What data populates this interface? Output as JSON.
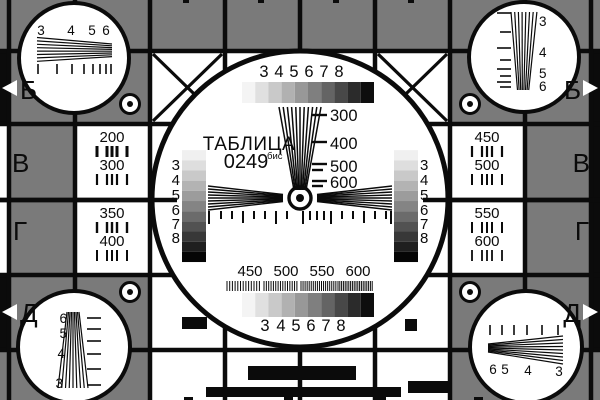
{
  "card": {
    "title_line1": "ТАБЛИЦА",
    "title_number": "0249",
    "title_superscript": "бис"
  },
  "row_labels": [
    "Б",
    "В",
    "Г",
    "Д"
  ],
  "scale_numbers": [
    "3",
    "4",
    "5",
    "6",
    "7",
    "8"
  ],
  "center_wedge_labels": [
    "300",
    "400",
    "500",
    "600"
  ],
  "bottom_freq_labels": [
    "450",
    "500",
    "550",
    "600"
  ],
  "freq_cells": {
    "left_top": [
      "200",
      "300"
    ],
    "left_bottom": [
      "350",
      "400"
    ],
    "right_top": [
      "450",
      "500"
    ],
    "right_bottom": [
      "550",
      "600"
    ]
  },
  "corner_numbers": {
    "top_left": [
      "3",
      "4",
      "5",
      "6"
    ],
    "top_right": [
      "3",
      "4",
      "5",
      "6"
    ],
    "bottom_left": [
      "6",
      "5",
      "4",
      "3"
    ],
    "bottom_right": [
      "6",
      "5",
      "4",
      "3"
    ]
  },
  "colors": {
    "background_gray": "#7a7a7a",
    "ink_black": "#0b0b0b",
    "paper_white": "#ffffff"
  },
  "grayscale_horizontal": [
    "#f4f4f4",
    "#e0e0e0",
    "#c9c9c9",
    "#b1b1b1",
    "#989898",
    "#7f7f7f",
    "#646464",
    "#484848",
    "#2b2b2b",
    "#0e0e0e"
  ],
  "grayscale_vertical": [
    "#ffffff",
    "#f0f0f0",
    "#dedede",
    "#c9c9c9",
    "#b3b3b3",
    "#9c9c9c",
    "#848484",
    "#6b6b6b",
    "#525252",
    "#383838",
    "#1f1f1f",
    "#050505"
  ]
}
